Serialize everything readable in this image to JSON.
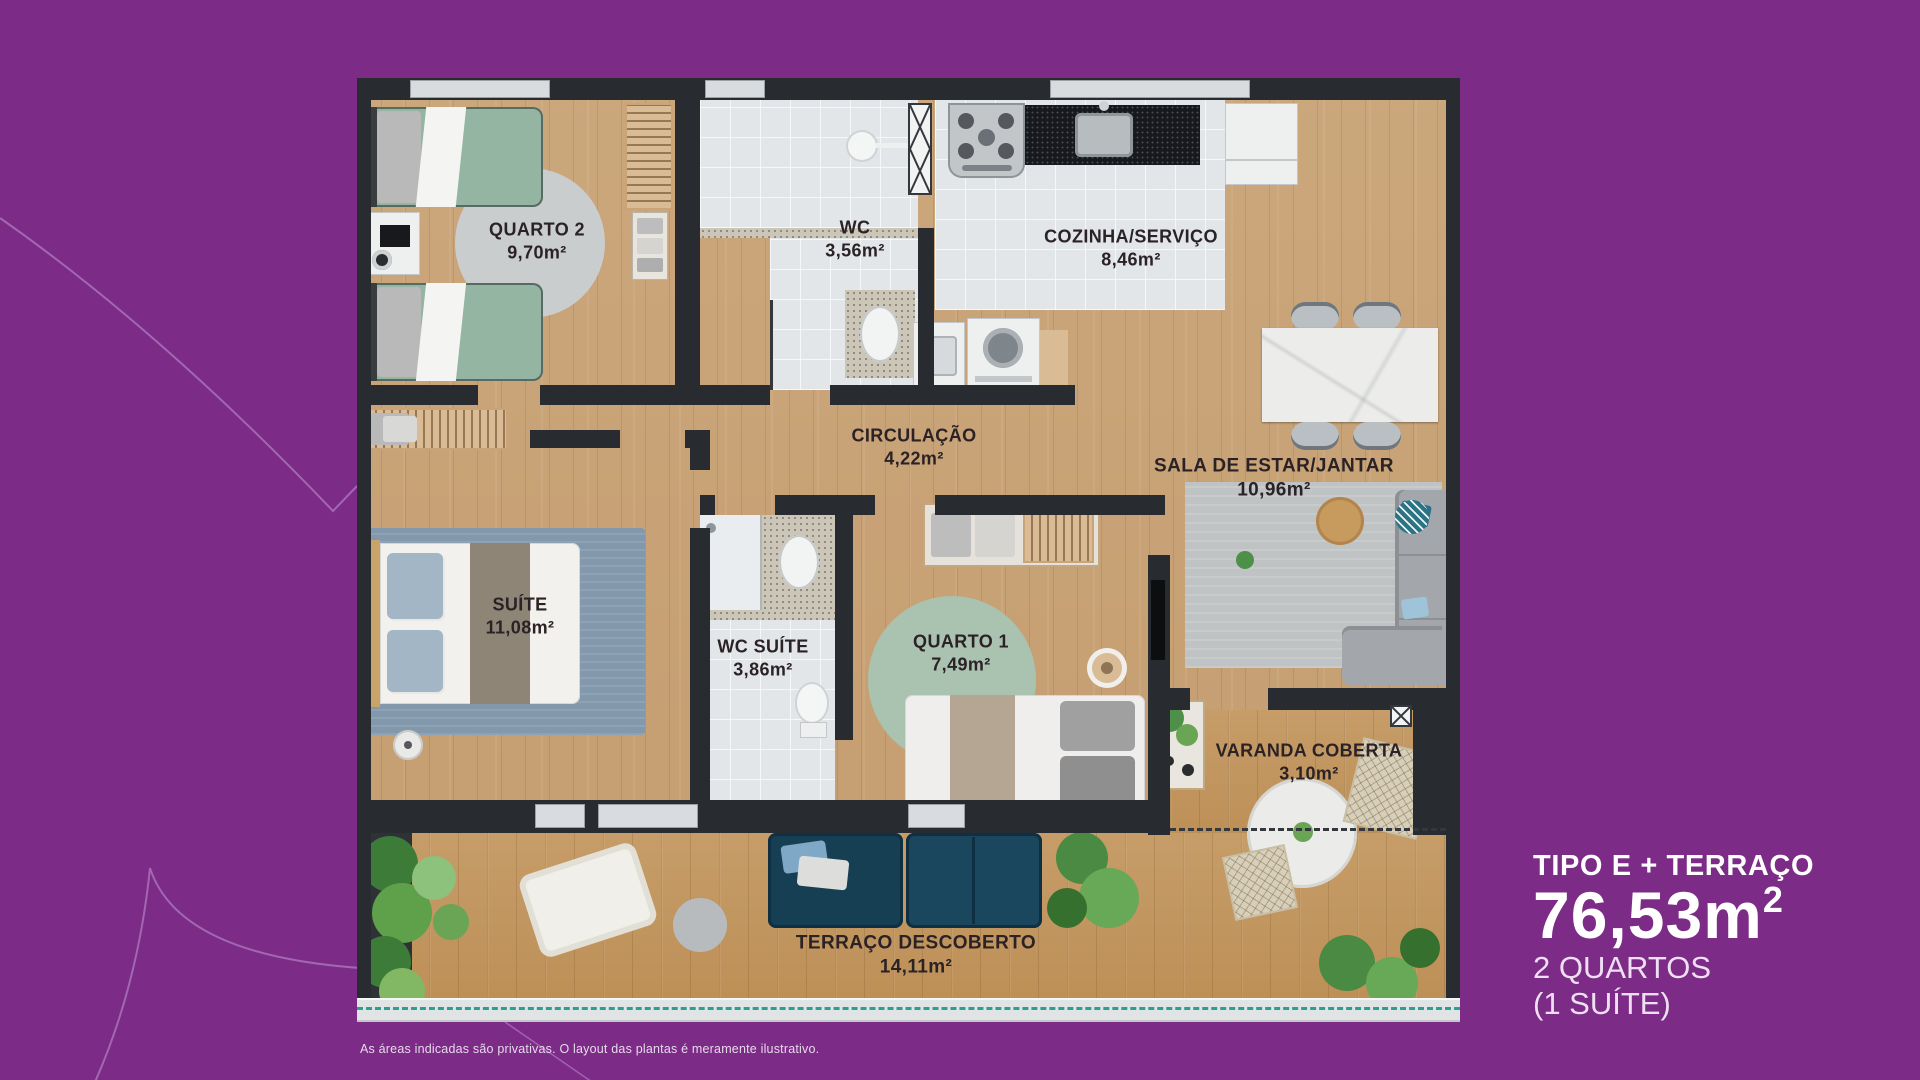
{
  "plan": {
    "rooms": {
      "quarto2": {
        "name": "QUARTO 2",
        "area": "9,70m²"
      },
      "wc": {
        "name": "WC",
        "area": "3,56m²"
      },
      "cozinha": {
        "name": "COZINHA/SERVIÇO",
        "area": "8,46m²"
      },
      "circulacao": {
        "name": "CIRCULAÇÃO",
        "area": "4,22m²"
      },
      "sala": {
        "name": "SALA DE ESTAR/JANTAR",
        "area": "10,96m²"
      },
      "suite": {
        "name": "SUÍTE",
        "area": "11,08m²"
      },
      "wc_suite": {
        "name": "WC SUÍTE",
        "area": "3,86m²"
      },
      "quarto1": {
        "name": "QUARTO 1",
        "area": "7,49m²"
      },
      "varanda": {
        "name": "VARANDA COBERTA",
        "area": "3,10m²"
      },
      "terraco": {
        "name": "TERRAÇO DESCOBERTO",
        "area": "14,11m²"
      }
    }
  },
  "info": {
    "type_label": "TIPO E + TERRAÇO",
    "area_value": "76,53m",
    "area_sup": "2",
    "bedrooms": "2 QUARTOS",
    "suite_note": "(1 SUÍTE)"
  },
  "disclaimer": "As áreas indicadas são privativas. O layout das plantas é meramente ilustrativo.",
  "colors": {
    "background_purple": "#7c2b87",
    "wall_dark": "#282c31",
    "wood": "#c7a176",
    "teal_dashed_line": "#2aa18c",
    "bed_green": "#93b5a2",
    "rug_blue": "#8298ac",
    "sofa_navy": "#173f54"
  }
}
